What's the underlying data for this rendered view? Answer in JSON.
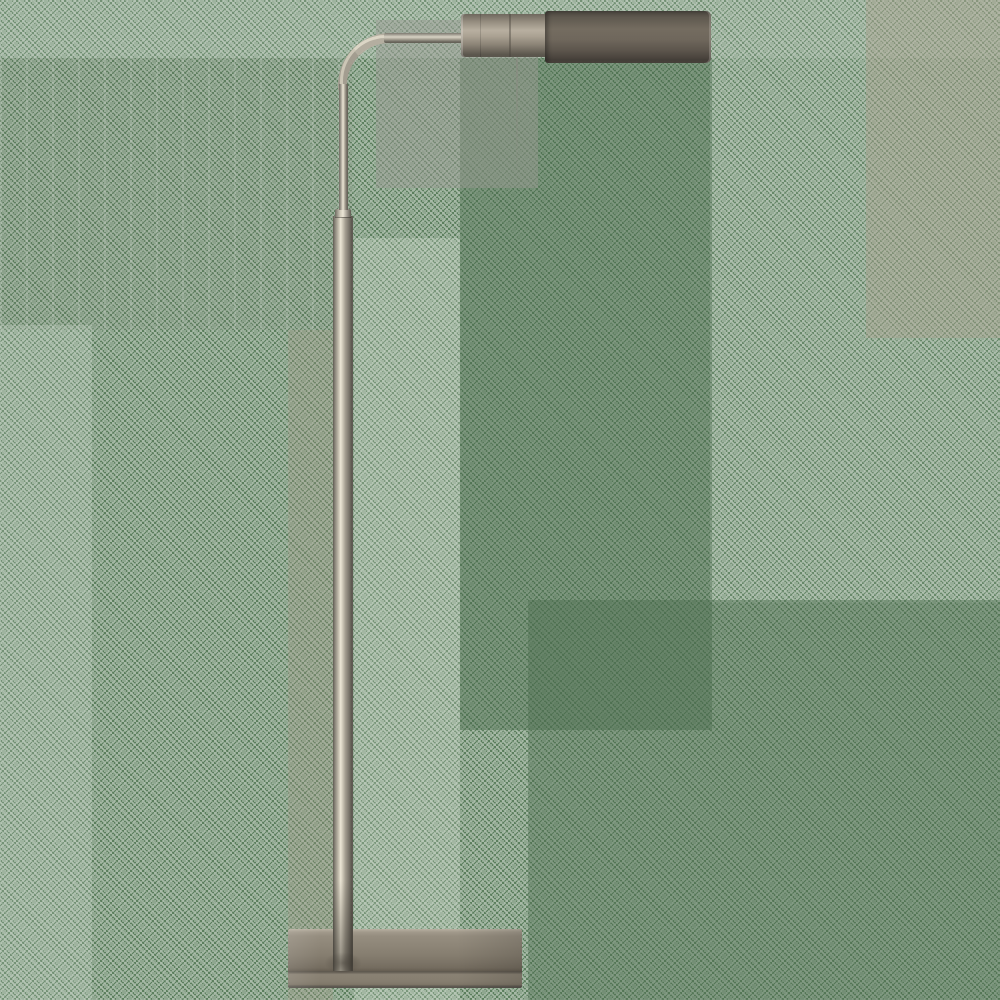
{
  "scene": {
    "subject": "Antique nickel adjustable pharmacy floor lamp with horizontal cylinder shade and rectangular metal base",
    "background": "green dithered watermark texture with lighter and darker rectangular zones",
    "text_content": "none"
  },
  "colors": {
    "bg-green": "#5b7e5d",
    "speckle-white": "rgba(244,246,240,0.55)",
    "zone-top": "rgba(255,255,255,0.15)",
    "zone-gray": "rgba(152,152,146,0.45)",
    "zone-dark-green": "rgba(72,105,73,0.42)",
    "zone-dark-green-weak": "rgba(75,108,77,0.40)",
    "zone-bright": "rgba(245,248,240,0.20)",
    "zone-white-weak": "rgba(245,248,240,0.16)",
    "zone-white-faint": "rgba(255,255,255,0.08)",
    "zone-tan": "rgba(170,158,140,0.38)",
    "zone-tan-weak": "rgba(160,148,128,0.30)",
    "metal-highlight": "#ece6d6",
    "metal-light": "#cfc9b9",
    "metal-mid": "#b4aea0",
    "metal-dark": "#6b675e",
    "metal-shadow": "#57524a",
    "head-dark-top": "#4a453e",
    "head-dark-mid": "#746c60",
    "head-dark-bottom": "#453f39",
    "head-light-top": "#6e685e",
    "head-light-mid": "#b8afa0",
    "head-light-bottom": "#5b564d",
    "base-top-edge": "#b9b1a2",
    "base-face": "#8d8577",
    "base-face-dark": "#7b7366",
    "base-seam": "#5e584f",
    "base-lip": "#8a8274",
    "base-bottom-edge": "#55504a"
  }
}
